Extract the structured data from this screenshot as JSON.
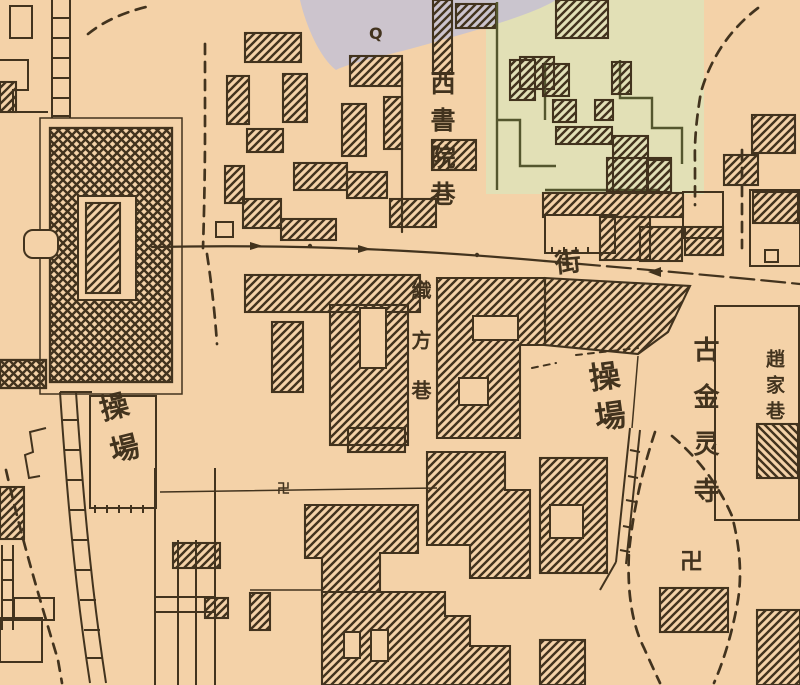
{
  "map": {
    "palette": {
      "paper": "#f4d2a8",
      "ink": "#42331e",
      "lavender_wash": "#c8c2d0",
      "green_wash": "#dee3b8",
      "olive_line": "#54562e"
    },
    "labels": [
      {
        "id": "west-academy-lane",
        "text": "西書院巷",
        "x": 429,
        "y": 70,
        "size": 25,
        "spacing": 12,
        "rotate": 0,
        "orient": "vertical"
      },
      {
        "id": "zhifang-lane",
        "text": "織方巷",
        "x": 410,
        "y": 280,
        "size": 20,
        "spacing": 30,
        "rotate": 0,
        "orient": "vertical"
      },
      {
        "id": "street-char",
        "text": "街",
        "x": 551,
        "y": 250,
        "size": 26,
        "spacing": 0,
        "rotate": -6,
        "orient": "vertical"
      },
      {
        "id": "drill-ground-right",
        "text": "操場",
        "x": 583,
        "y": 363,
        "size": 31,
        "spacing": 9,
        "rotate": -8,
        "orient": "vertical"
      },
      {
        "id": "drill-ground-left",
        "text": "操場",
        "x": 94,
        "y": 396,
        "size": 29,
        "spacing": 14,
        "rotate": -14,
        "orient": "vertical"
      },
      {
        "id": "ancient-jinling-temple",
        "text": "古金灵寺",
        "x": 691,
        "y": 336,
        "size": 26,
        "spacing": 21,
        "rotate": 0,
        "orient": "vertical"
      },
      {
        "id": "zhaojia-lane",
        "text": "趙家巷",
        "x": 764,
        "y": 349,
        "size": 19,
        "spacing": 7,
        "rotate": 0,
        "orient": "vertical"
      },
      {
        "id": "temple-swastika",
        "text": "卍",
        "x": 680,
        "y": 551,
        "size": 23,
        "spacing": 0,
        "rotate": 0,
        "orient": "single"
      },
      {
        "id": "small-swastika",
        "text": "卍",
        "x": 277,
        "y": 483,
        "size": 13,
        "spacing": 0,
        "rotate": 0,
        "orient": "single"
      },
      {
        "id": "well-mark",
        "text": "Q",
        "x": 369,
        "y": 26,
        "size": 16,
        "spacing": 0,
        "rotate": 0,
        "orient": "single"
      }
    ]
  }
}
